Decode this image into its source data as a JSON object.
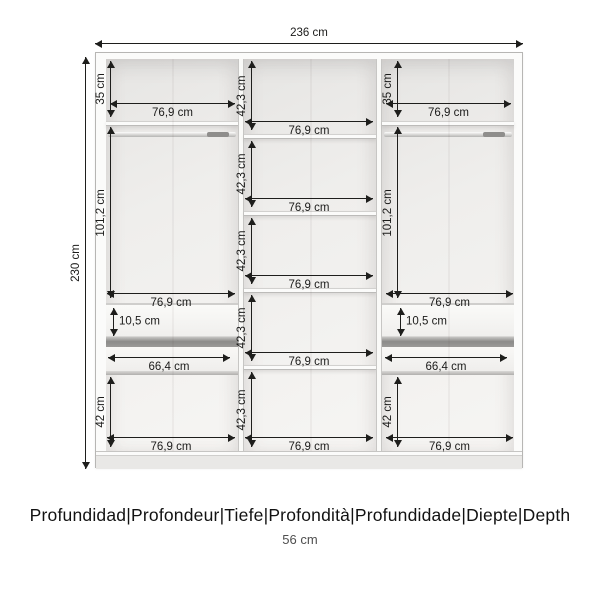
{
  "wardrobe": {
    "overall": {
      "width": "236 cm",
      "height": "230 cm"
    },
    "dims": {
      "top_section_height": "35 cm",
      "shelf_section_height": "42,3 cm",
      "hanging_section_height": "101,2 cm",
      "section_width": "76,9 cm",
      "drawer_front_height": "10,5 cm",
      "drawer_width": "66,4 cm",
      "bottom_section_height": "42 cm"
    }
  },
  "footer": {
    "depth_label": "Profundidad|Profondeur|Tiefe|Profondità|Profundidade|Diepte|Depth",
    "depth_value": "56 cm"
  }
}
